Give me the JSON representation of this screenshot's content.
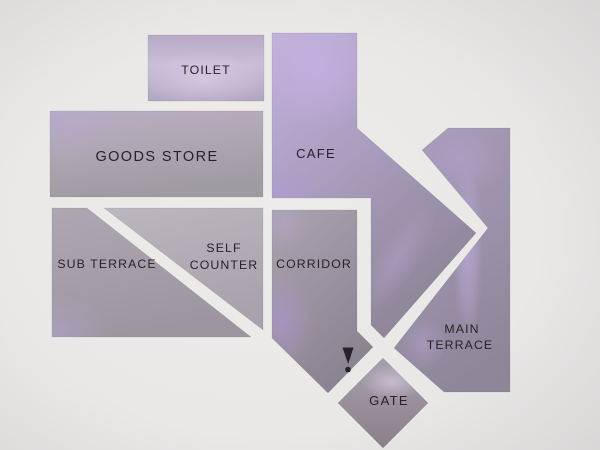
{
  "sign": {
    "areas": [
      {
        "id": "toilet",
        "label": "TOILET"
      },
      {
        "id": "goods-store",
        "label": "GOODS STORE"
      },
      {
        "id": "cafe",
        "label": "CAFE"
      },
      {
        "id": "sub-terrace",
        "label": "SUB TERRACE"
      },
      {
        "id": "self-counter",
        "line1": "SELF",
        "line2": "COUNTER"
      },
      {
        "id": "corridor",
        "label": "CORRIDOR"
      },
      {
        "id": "main-terrace",
        "line1": "MAIN",
        "line2": "TERRACE"
      },
      {
        "id": "gate",
        "label": "GATE"
      }
    ],
    "marker": {
      "glyph": "!"
    },
    "colors": {
      "wall": "#eae8e7",
      "label_text": "#26222a",
      "panel_lavender": "#c0b1d2",
      "panel_purple": "#b2a0cf",
      "panel_gray": "#a59ea9",
      "panel_dark": "#8d8692"
    }
  }
}
